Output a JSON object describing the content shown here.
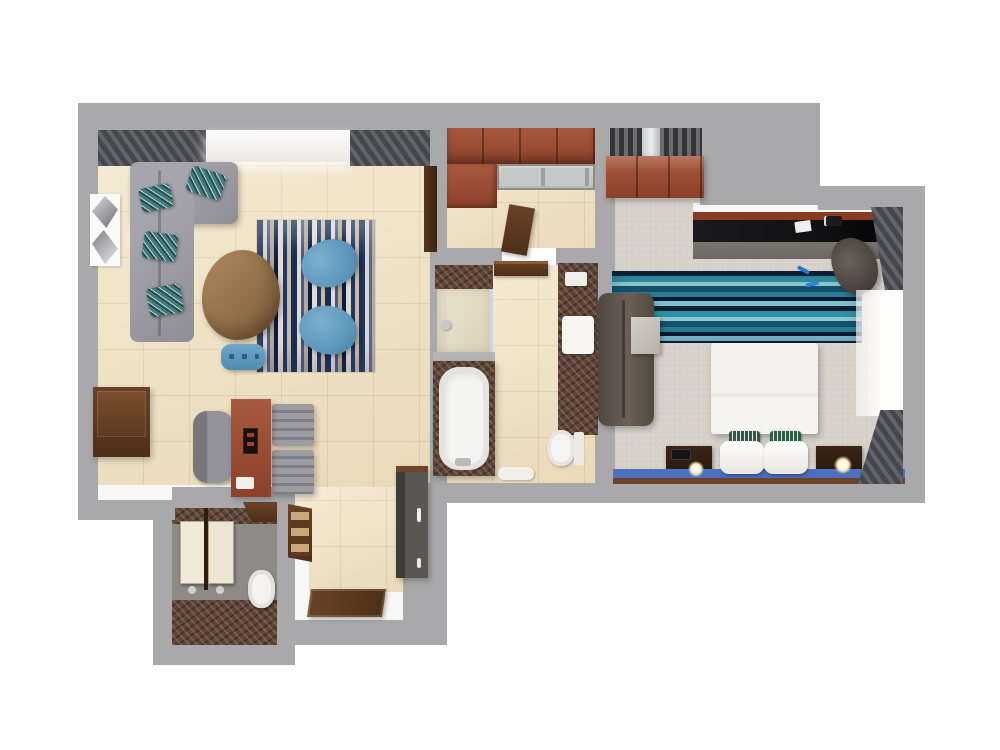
{
  "canvas": {
    "width": 1000,
    "height": 750,
    "background": "#ffffff"
  },
  "colors": {
    "outside": "#ffffff",
    "wall": "#a9a9ab",
    "faceWhite": "#f7f7f5",
    "tile": "#f0e2c2",
    "carpet": "#d7d1ca",
    "laundryFloor": "#8e8a85",
    "marble": "#5f4434",
    "woodRed": "#8c4129",
    "woodDark": "#4e2f18",
    "sofaGray": "#8f8e95",
    "tealPillow": "#3e7d80",
    "curtain": "#46474c",
    "rugNavy": "#1d2c50",
    "rugTan": "#b3aa9b",
    "rugTeal": "#2f8fa3",
    "blueChair": "#5a95ba",
    "deskBlack": "#121214",
    "deskFront": "#6b6763",
    "bedWhite": "#f3f1ee",
    "pillowGreen": "#2f5c44",
    "runnerBlue": "#4d6fc0",
    "lampGlow": "#f7ecc0",
    "windowLight": "#fdfdfc"
  },
  "plan": {
    "type": "3d-rendered-floor-plan",
    "rooms": [
      {
        "id": "living-room",
        "furniture": [
          "l-shaped-sectional-sofa",
          "teal-accent-pillows",
          "geometric-wall-art",
          "pebble-coffee-table",
          "striped-area-rug",
          "blue-swivel-chair",
          "blue-swivel-chair",
          "blue-ottoman",
          "wall-console",
          "writing-desk",
          "desk-chair",
          "luggage-rack",
          "window-with-curtains"
        ]
      },
      {
        "id": "closet-kitchenette",
        "furniture": [
          "upper-cabinets",
          "glass-counter",
          "open-door"
        ]
      },
      {
        "id": "bathroom",
        "furniture": [
          "walk-in-shower",
          "bathtub",
          "marble-vanity",
          "sink",
          "toilet",
          "bath-mat",
          "towel-shelf"
        ]
      },
      {
        "id": "entry-hall",
        "furniture": [
          "minibar-wardrobe",
          "wall-shelf",
          "entry-door-mat"
        ]
      },
      {
        "id": "powder-room",
        "furniture": [
          "twin-washbasins",
          "toilet",
          "corner-shelf"
        ]
      },
      {
        "id": "bedroom",
        "furniture": [
          "window-blind",
          "dresser",
          "media-desk",
          "desk-chair",
          "teal-striped-rug",
          "lounge-sofa",
          "side-table",
          "double-bed",
          "white-pillows",
          "green-accent-pillows",
          "nightstand",
          "nightstand",
          "table-lamps",
          "sheer-window-curtain",
          "blackout-curtains",
          "blue-bed-runner"
        ]
      }
    ]
  }
}
